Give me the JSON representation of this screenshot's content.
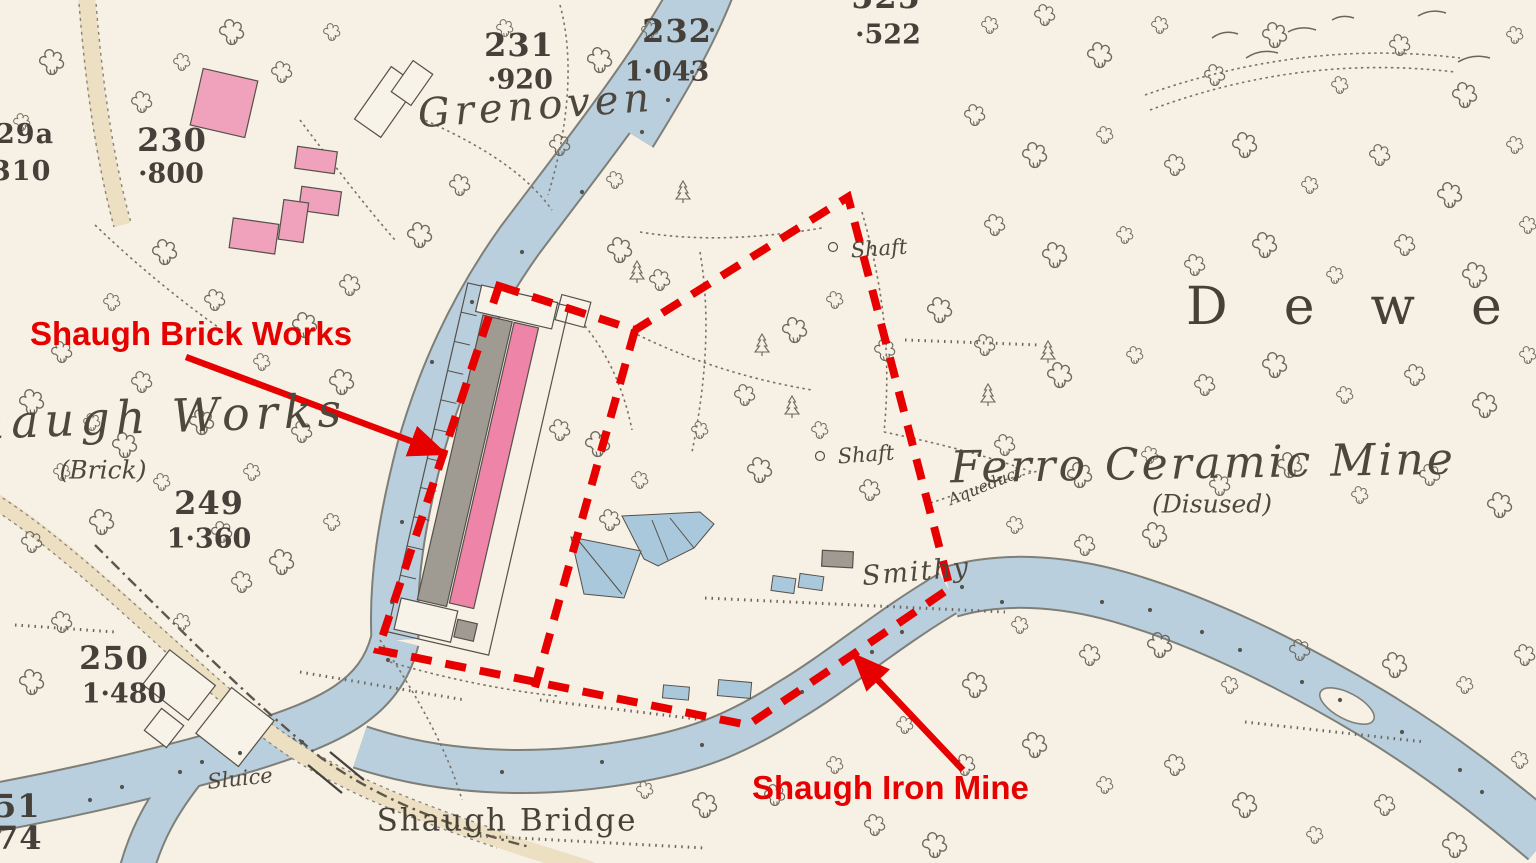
{
  "map_type": "annotated historic ordnance survey map extract",
  "colors": {
    "paper": "#f6f1e4",
    "water": "#b9cfdd",
    "road": "#ecdfc2",
    "building_pink": "#f0a2bc",
    "works_pink": "#ee85a8",
    "building_gray": "#9f9a92",
    "map_ink": "#55504a",
    "annotation_red": "#e60000"
  },
  "annotations": {
    "brick_works": "Shaugh Brick Works",
    "iron_mine": "Shaugh Iron Mine"
  },
  "labels": {
    "grenoven": "Grenoven",
    "shaugh_works": "Shaugh Works",
    "brick": "(Brick)",
    "ferro": "Ferro Ceramic Mine",
    "disused": "(Disused)",
    "dewe": "Dewe",
    "smithy": "Smithy",
    "shaft1": "Shaft",
    "shaft2": "Shaft",
    "aqueduct": "Aqueduct",
    "sluice": "Sluice",
    "shaugh_bridge": "Shaugh Bridge"
  },
  "parcel_numbers": {
    "n231": "231",
    "a231": "·920",
    "n232": "232",
    "a232": "1·043",
    "n525": "525",
    "a525": "·522",
    "n229a": "29a",
    "a229a": "310",
    "n230": "230",
    "a230": "·800",
    "n249": "249",
    "a249": "1·360",
    "n250": "250",
    "a250": "1·480",
    "n51": "51",
    "n74": "74"
  }
}
